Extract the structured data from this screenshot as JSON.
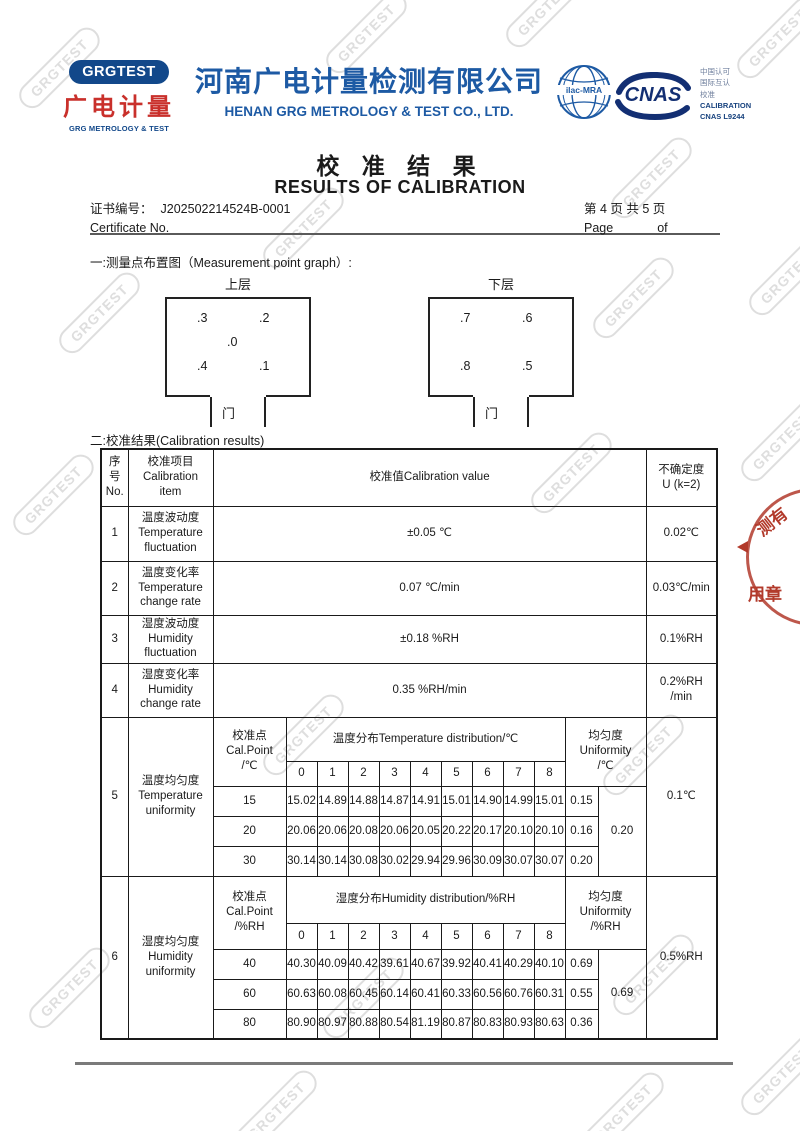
{
  "watermark_text": "GRGTEST",
  "colors": {
    "brand_blue": "#1d5aa4",
    "logo_navy": "#12488a",
    "logo_red": "#c9302b",
    "stamp_red": "#b23a2b",
    "watermark_gray": "#dedede"
  },
  "header": {
    "logo_pill": "GRGTEST",
    "logo_cn": "广电计量",
    "logo_en": "GRG METROLOGY & TEST",
    "company_cn": "河南广电计量检测有限公司",
    "company_en": "HENAN GRG METROLOGY & TEST CO., LTD.",
    "ilac_label": "ilac-MRA",
    "cnas_label": "CNAS",
    "accreditation_lines": [
      "中国认可",
      "国际互认",
      "校准",
      "CALIBRATION",
      "CNAS L9244"
    ]
  },
  "title": {
    "cn": "校 准 结 果",
    "en": "RESULTS OF CALIBRATION"
  },
  "certificate": {
    "label_cn": "证书编号：",
    "number": "J202502214524B-0001",
    "label_en": "Certificate No.",
    "page_line_cn": "第 4  页  共 5  页",
    "page_en": "Page",
    "of_en": "of"
  },
  "section1": {
    "heading": "一:测量点布置图（Measurement point graph）:",
    "upper": {
      "label": "上层",
      "door": "门",
      "points": [
        ".3",
        ".2",
        ".0",
        ".4",
        ".1"
      ]
    },
    "lower": {
      "label": "下层",
      "door": "门",
      "points": [
        ".7",
        ".6",
        ".8",
        ".5"
      ]
    }
  },
  "section2": {
    "heading": "二:校准结果(Calibration results)",
    "table": {
      "head": {
        "no": "序\n号\nNo.",
        "item": "校准项目\nCalibration\nitem",
        "value": "校准值Calibration value",
        "uncertainty": "不确定度\nU (k=2)"
      },
      "rows": [
        {
          "no": "1",
          "item": "温度波动度\nTemperature\nfluctuation",
          "value": "±0.05 ℃",
          "uncertainty": "0.02℃"
        },
        {
          "no": "2",
          "item": "温度变化率\nTemperature\nchange rate",
          "value": "0.07 ℃/min",
          "uncertainty": "0.03℃/min"
        },
        {
          "no": "3",
          "item": "湿度波动度\nHumidity\nfluctuation",
          "value": "±0.18 %RH",
          "uncertainty": "0.1%RH"
        },
        {
          "no": "4",
          "item": "湿度变化率\nHumidity\nchange rate",
          "value": "0.35 %RH/min",
          "uncertainty": "0.2%RH\n/min"
        }
      ],
      "row5": {
        "no": "5",
        "item": "温度均匀度\nTemperature\nuniformity",
        "calpoint": "校准点\nCal.Point\n/℃",
        "dist_label": "温度分布Temperature distribution/℃",
        "unif_label": "均匀度\nUniformity\n/℃",
        "cols": [
          "0",
          "1",
          "2",
          "3",
          "4",
          "5",
          "6",
          "7",
          "8"
        ],
        "points": [
          {
            "cal": "15",
            "values": [
              "15.02",
              "14.89",
              "14.88",
              "14.87",
              "14.91",
              "15.01",
              "14.90",
              "14.99",
              "15.01"
            ],
            "unif": "0.15"
          },
          {
            "cal": "20",
            "values": [
              "20.06",
              "20.06",
              "20.08",
              "20.06",
              "20.05",
              "20.22",
              "20.17",
              "20.10",
              "20.10"
            ],
            "unif": "0.16"
          },
          {
            "cal": "30",
            "values": [
              "30.14",
              "30.14",
              "30.08",
              "30.02",
              "29.94",
              "29.96",
              "30.09",
              "30.07",
              "30.07"
            ],
            "unif": "0.20"
          }
        ],
        "unif_overall": "0.20",
        "uncertainty": "0.1℃"
      },
      "row6": {
        "no": "6",
        "item": "湿度均匀度\nHumidity\nuniformity",
        "calpoint": "校准点\nCal.Point\n/%RH",
        "dist_label": "湿度分布Humidity  distribution/%RH",
        "unif_label": "均匀度\nUniformity\n/%RH",
        "cols": [
          "0",
          "1",
          "2",
          "3",
          "4",
          "5",
          "6",
          "7",
          "8"
        ],
        "points": [
          {
            "cal": "40",
            "values": [
              "40.30",
              "40.09",
              "40.42",
              "39.61",
              "40.67",
              "39.92",
              "40.41",
              "40.29",
              "40.10"
            ],
            "unif": "0.69"
          },
          {
            "cal": "60",
            "values": [
              "60.63",
              "60.08",
              "60.45",
              "60.14",
              "60.41",
              "60.33",
              "60.56",
              "60.76",
              "60.31"
            ],
            "unif": "0.55"
          },
          {
            "cal": "80",
            "values": [
              "80.90",
              "80.97",
              "80.88",
              "80.54",
              "81.19",
              "80.87",
              "80.83",
              "80.93",
              "80.63"
            ],
            "unif": "0.36"
          }
        ],
        "unif_overall": "0.69",
        "uncertainty": "0.5%RH"
      }
    }
  },
  "stamp": {
    "chars_top": "测有",
    "chars_bottom": "用章"
  }
}
